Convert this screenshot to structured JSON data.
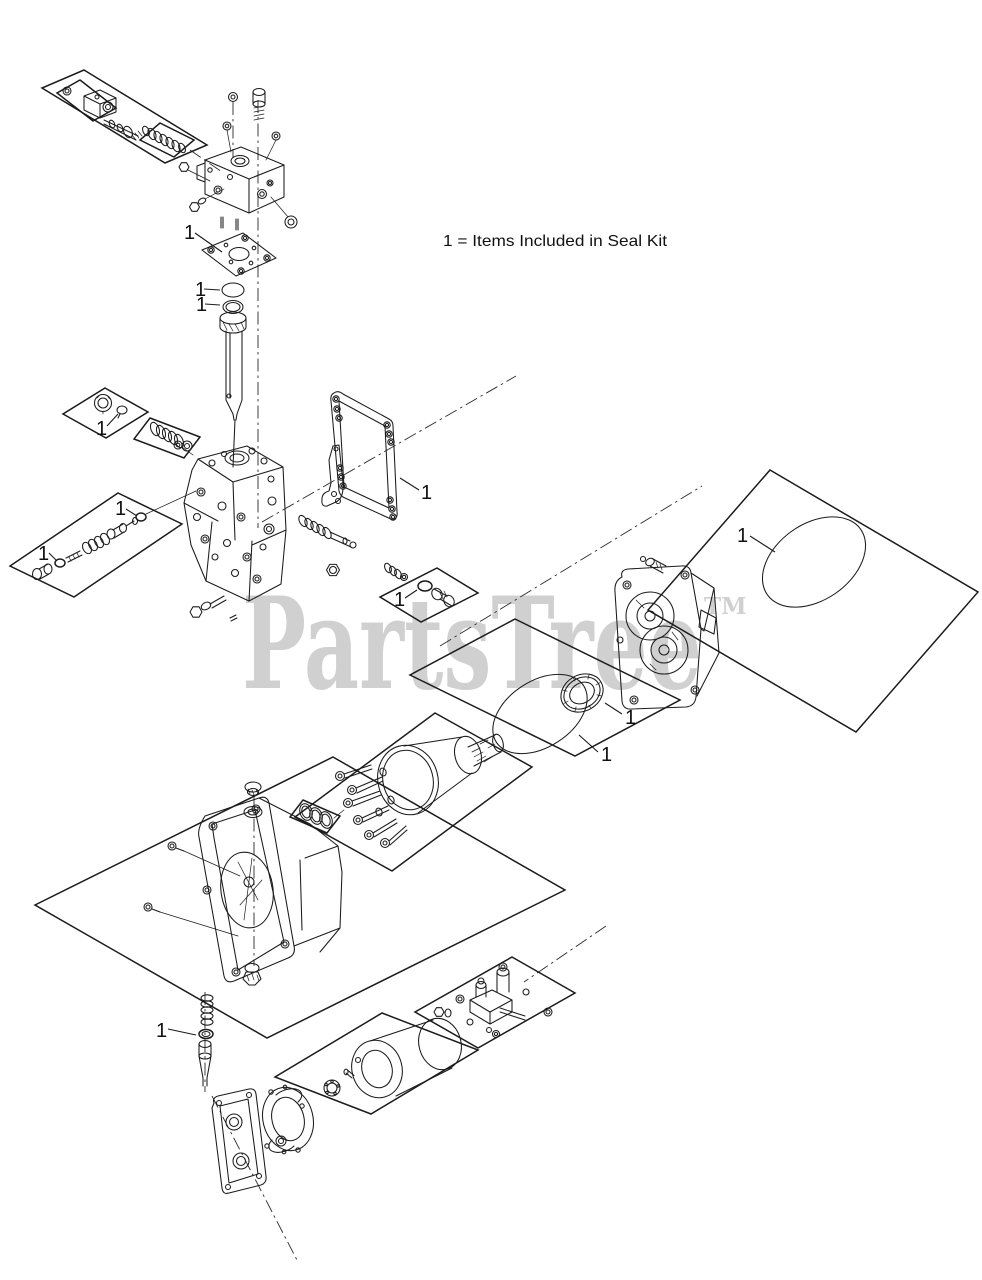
{
  "diagram": {
    "title_hidden": "",
    "legend": "1 = Items Included in Seal Kit",
    "watermark": "PartsTree",
    "watermark_tm": "TM",
    "background": "#ffffff",
    "line_color": "#1b1b1b",
    "watermark_color": "#d0d0d0"
  },
  "callouts": [
    {
      "label": "1",
      "part": "cover-gasket"
    },
    {
      "label": "1",
      "part": "o-ring-upper"
    },
    {
      "label": "1",
      "part": "backup-ring-upper"
    },
    {
      "label": "1",
      "part": "plug-seat"
    },
    {
      "label": "1",
      "part": "relief-valve-o-ring-front"
    },
    {
      "label": "1",
      "part": "relief-valve-o-ring-rear"
    },
    {
      "label": "1",
      "part": "body-gasket"
    },
    {
      "label": "1",
      "part": "cap-o-ring"
    },
    {
      "label": "1",
      "part": "large-o-ring"
    },
    {
      "label": "1",
      "part": "shaft-seal"
    },
    {
      "label": "1",
      "part": "housing-o-ring"
    },
    {
      "label": "1",
      "part": "bypass-valve-seal"
    }
  ]
}
